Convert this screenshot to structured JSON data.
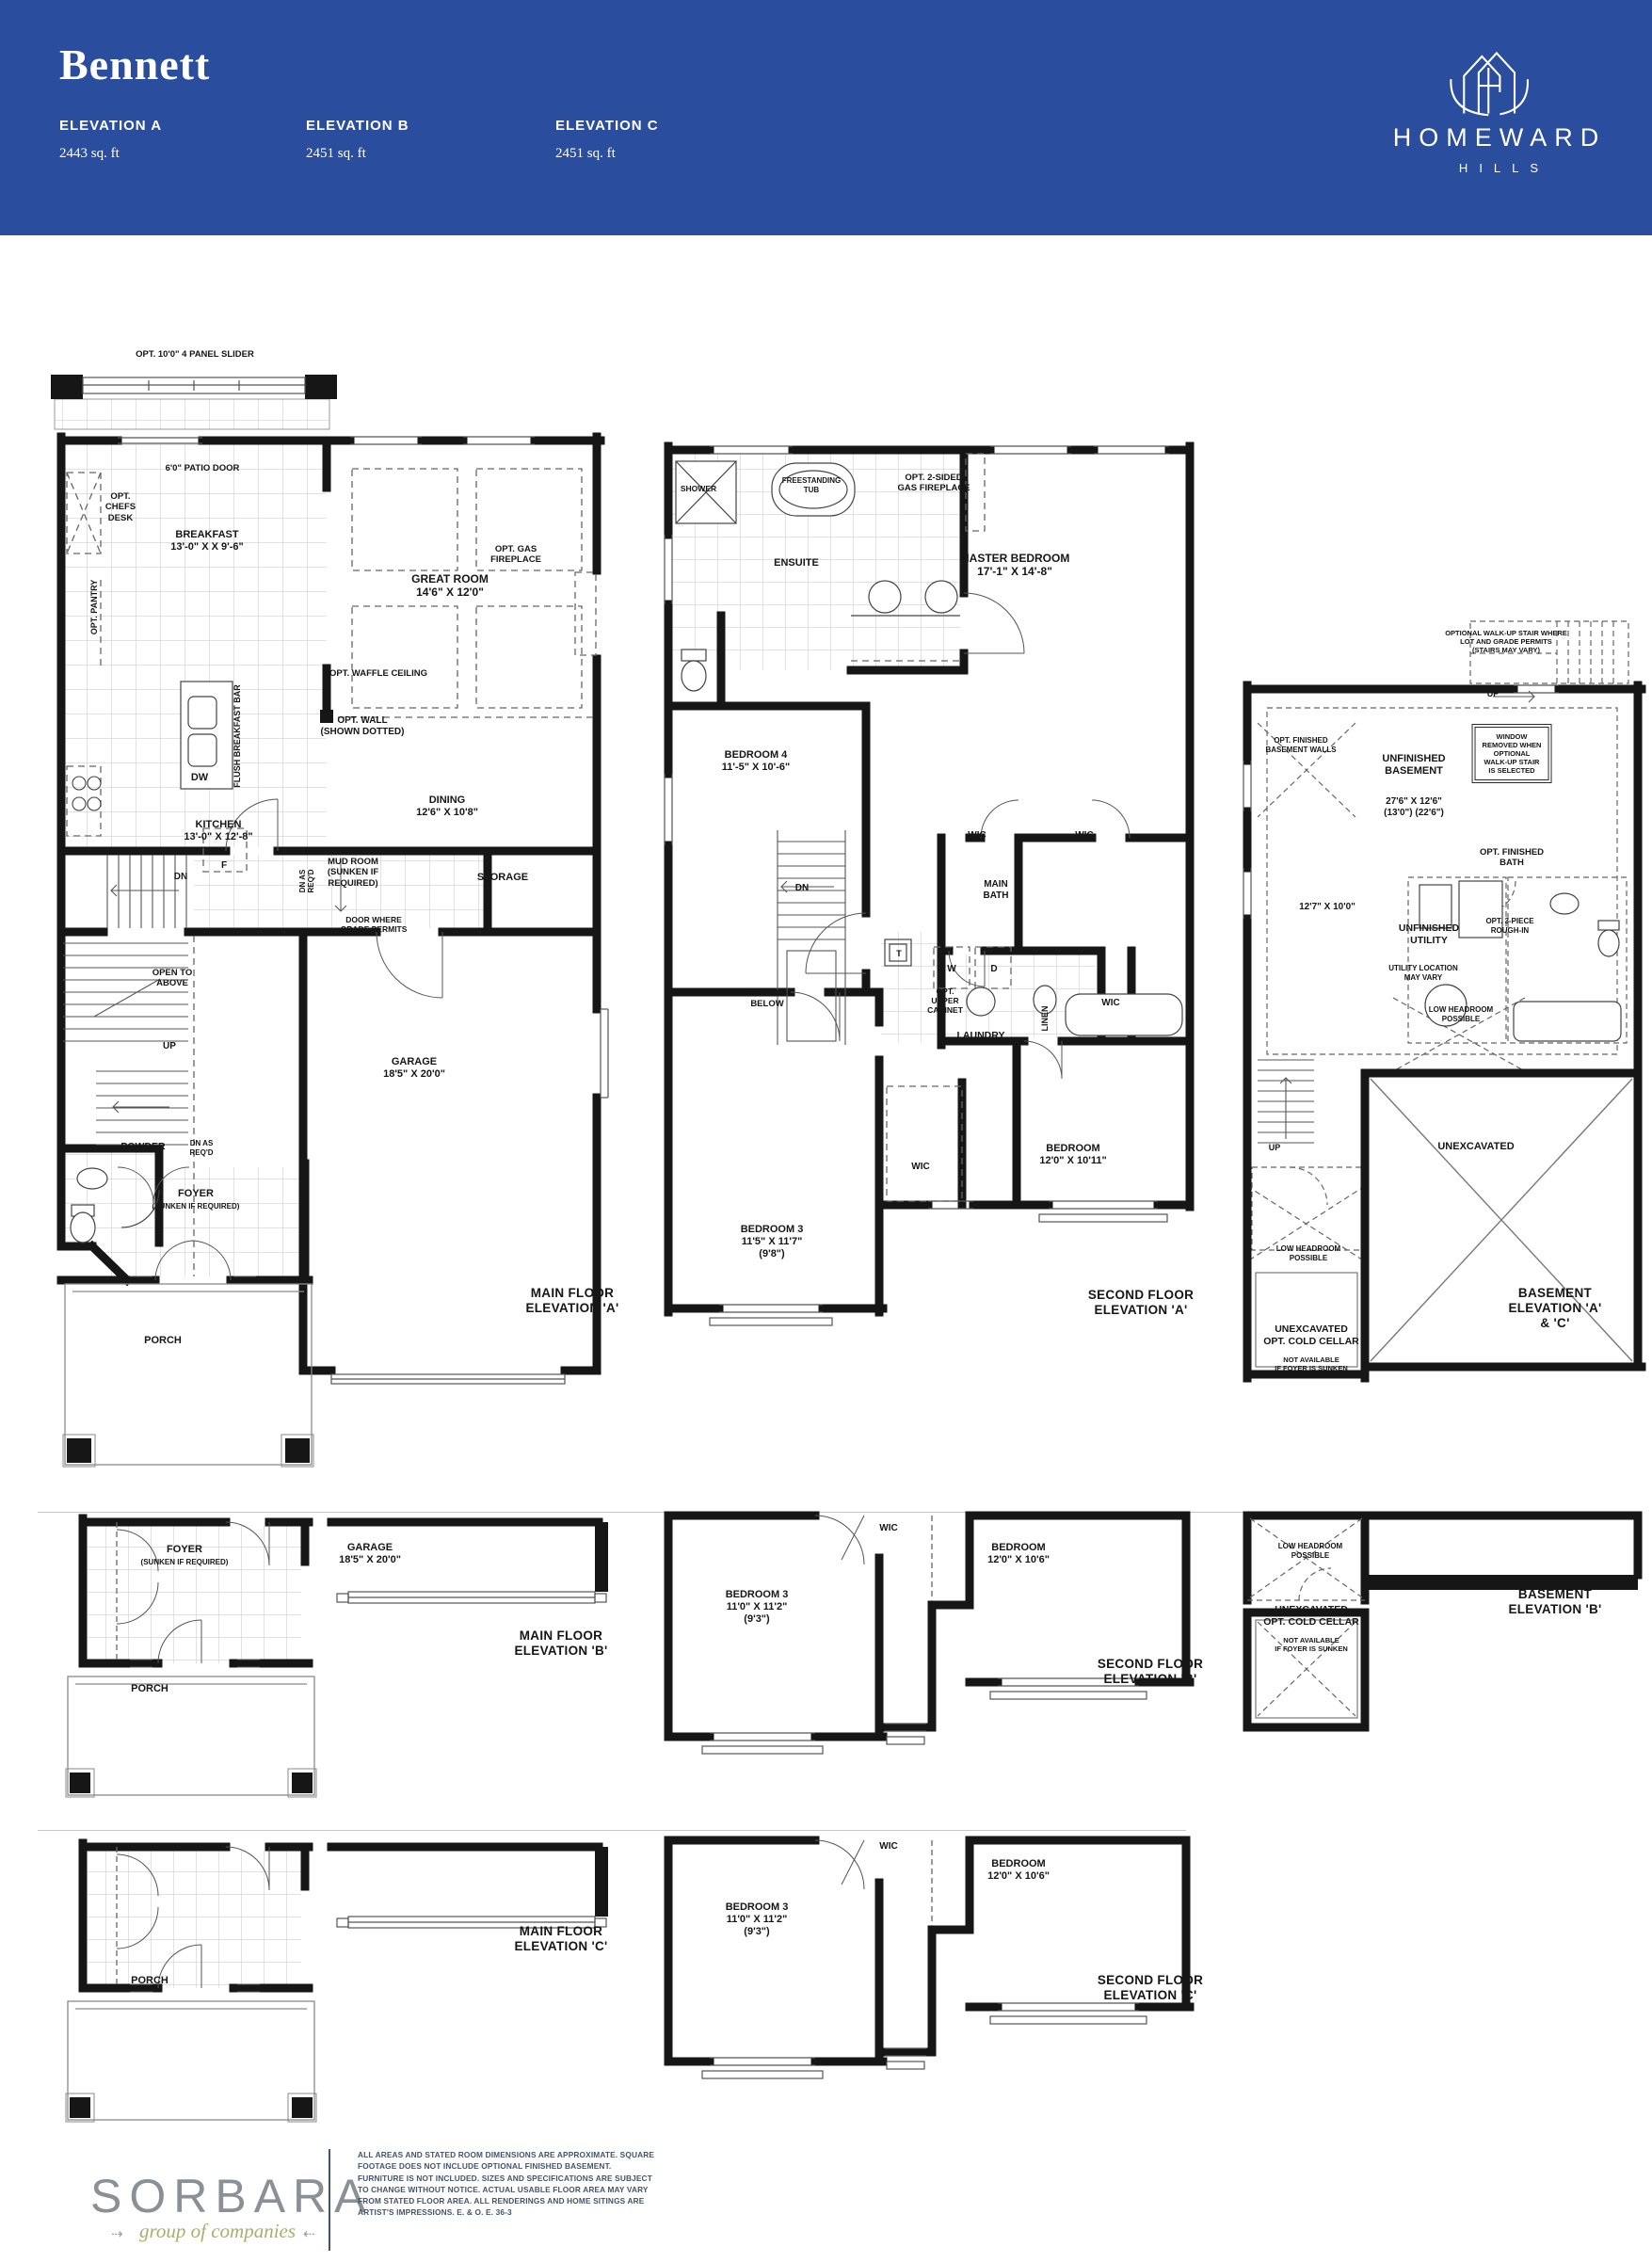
{
  "header": {
    "title": "Bennett",
    "elevations": [
      {
        "name": "ELEVATION A",
        "sqft": "2443 sq. ft"
      },
      {
        "name": "ELEVATION B",
        "sqft": "2451 sq. ft"
      },
      {
        "name": "ELEVATION C",
        "sqft": "2451 sq. ft"
      }
    ],
    "brand": {
      "line1": "HOMEWARD",
      "line2": "HILLS"
    },
    "colors": {
      "banner": "#2b4d9d"
    }
  },
  "labels": {
    "slider": "OPT. 10'0\" 4 PANEL SLIDER",
    "patio_door": "6'0\" PATIO DOOR",
    "chefs_desk": "OPT.\nCHEFS\nDESK",
    "pantry": "OPT. PANTRY",
    "breakfast": "BREAKFAST\n13'-0\" X X 9'-6\"",
    "great_room": "GREAT ROOM\n14'6\" X 12'0\"",
    "gas_fireplace": "OPT. GAS\nFIREPLACE",
    "waffle_ceiling": "OPT. WAFFLE CEILING",
    "opt_wall": "OPT. WALL\n(SHOWN DOTTED)",
    "flush_bar": "FLUSH BREAKFAST BAR",
    "dw": "DW",
    "kitchen": "KITCHEN\n13'-0\" X 12'-8\"",
    "fridge": "F",
    "dining": "DINING\n12'6\" X 10'8\"",
    "dn": "DN",
    "dn_as_reqd": "DN AS\nREQ'D",
    "mud_room": "MUD ROOM\n(SUNKEN IF\nREQUIRED)",
    "storage": "STORAGE",
    "door_grade": "DOOR WHERE\nGRADE PERMITS",
    "open_above": "OPEN TO\nABOVE",
    "up": "UP",
    "garage": "GARAGE\n18'5\" X 20'0\"",
    "powder": "POWDER",
    "foyer": "FOYER",
    "foyer_note": "(SUNKEN IF REQUIRED)",
    "porch": "PORCH",
    "main_a_caption": "MAIN FLOOR\nELEVATION 'A'",
    "shower": "SHOWER",
    "tub": "FREESTANDING\nTUB",
    "ensuite": "ENSUITE",
    "fireplace_2sided": "OPT. 2-SIDED\nGAS FIREPLACE",
    "master": "MASTER BEDROOM\n17'-1\" X 14'-8\"",
    "bedroom4": "BEDROOM 4\n11'-5\" X 10'-6\"",
    "wic": "WIC",
    "main_bath": "MAIN\nBATH",
    "open_below": "OPEN TO\nBELOW",
    "t": "T",
    "w": "W",
    "d": "D",
    "upper_cabinet": "OPT.\nUPPER\nCABINET",
    "laundry": "LAUNDRY",
    "linen": "LINEN",
    "bedroom_a": "BEDROOM\n12'0\" X 10'11\"",
    "bedroom3_a": "BEDROOM 3\n11'5\" X 11'7\"\n(9'8\")",
    "second_a_caption": "SECOND FLOOR\nELEVATION 'A'",
    "walkup_note": "OPTIONAL WALK-UP STAIR WHERE\nLOT AND GRADE PERMITS\n(STAIRS MAY VARY)",
    "fin_walls": "OPT. FINISHED\nBASEMENT WALLS",
    "unfinished_basement": "UNFINISHED\nBASEMENT",
    "window_removed": "WINDOW\nREMOVED WHEN\nOPTIONAL\nWALK-UP STAIR\nIS SELECTED",
    "bsmt_dims": "27'6\" X 12'6\"\n(13'0\") (22'6\")",
    "fin_bath": "OPT. FINISHED\nBATH",
    "bsmt_dims2": "12'7\" X 10'0\"",
    "unfinished_utility": "UNFINISHED\nUTILITY",
    "rough_in": "OPT. 3-PIECE\nROUGH-IN",
    "utility_loc": "UTILITY LOCATION\nMAY VARY",
    "low_headroom": "LOW HEADROOM\nPOSSIBLE",
    "unexcavated": "UNEXCAVATED",
    "cold_cellar": "UNEXCAVATED\nOPT. COLD CELLAR",
    "cold_cellar_note": "NOT AVAILABLE\nIF FOYER IS SUNKEN",
    "basement_ac_caption": "BASEMENT\nELEVATION 'A' & 'C'",
    "main_b_caption": "MAIN FLOOR\nELEVATION 'B'",
    "bedroom_bc": "BEDROOM\n12'0\" X 10'6\"",
    "bedroom3_bc": "BEDROOM 3\n11'0\" X 11'2\"\n(9'3\")",
    "second_b_caption": "SECOND FLOOR\nELEVATION 'B'",
    "basement_b_caption": "BASEMENT\nELEVATION 'B'",
    "main_c_caption": "MAIN FLOOR\nELEVATION 'C'",
    "second_c_caption": "SECOND FLOOR\nELEVATION 'C'"
  },
  "footer": {
    "logo": "SORBARA",
    "logo_sub": "group of companies",
    "arrow_left_glyph": "⇢",
    "arrow_right_glyph": "⇠",
    "disclaimer": "ALL AREAS AND STATED ROOM DIMENSIONS ARE APPROXIMATE. SQUARE FOOTAGE DOES NOT INCLUDE OPTIONAL FINISHED BASEMENT. FURNITURE IS NOT INCLUDED. SIZES AND SPECIFICATIONS ARE SUBJECT TO CHANGE WITHOUT NOTICE. ACTUAL USABLE FLOOR AREA MAY VARY FROM STATED FLOOR AREA. ALL RENDERINGS AND HOME SITINGS ARE ARTIST'S IMPRESSIONS. E. & O. E.  36-3"
  }
}
